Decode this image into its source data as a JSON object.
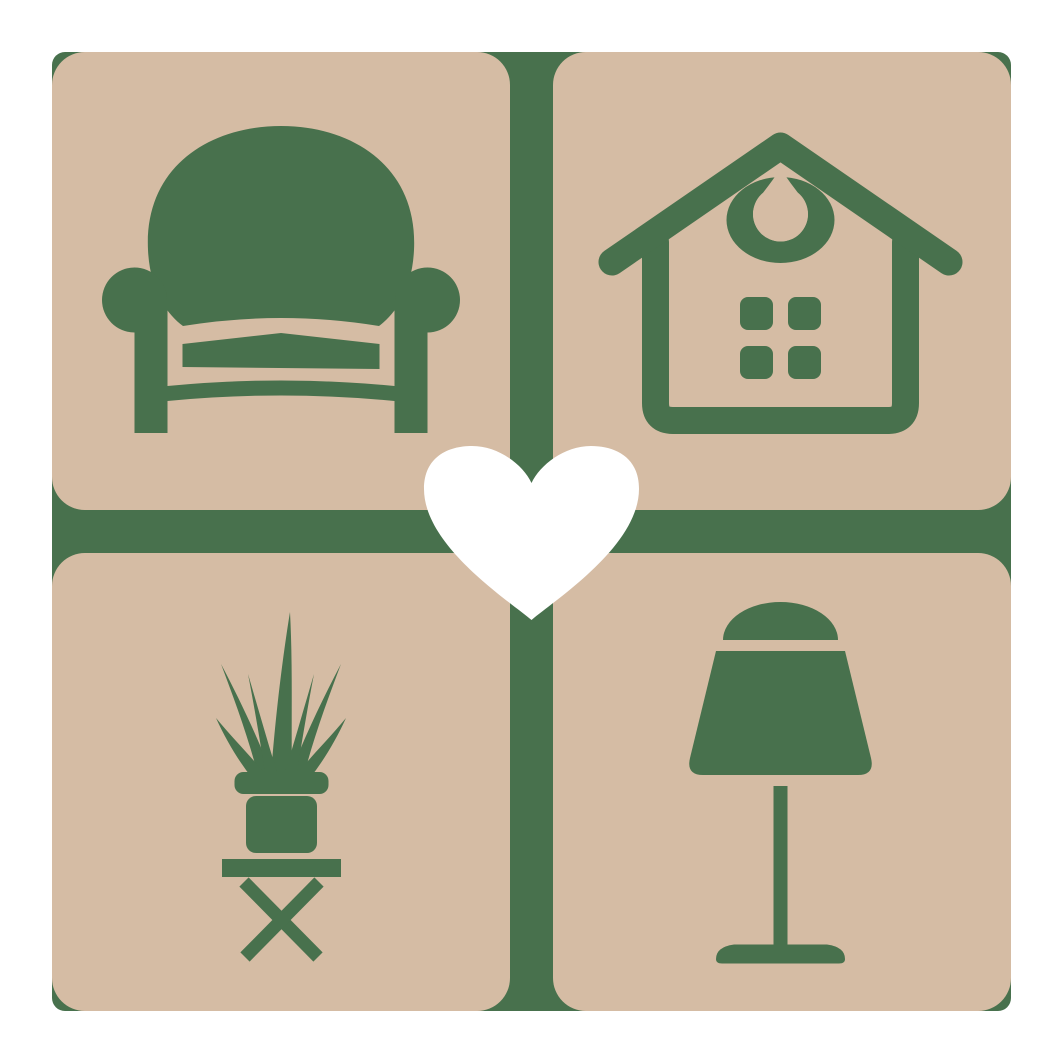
{
  "logo": {
    "colors": {
      "background": "#ffffff",
      "tile": "#d5bca4",
      "icon": "#48714d",
      "heart": "#ffffff"
    },
    "quadrants": [
      {
        "position": "top-left",
        "icon": "armchair-icon"
      },
      {
        "position": "top-right",
        "icon": "house-icon"
      },
      {
        "position": "bottom-left",
        "icon": "potted-plant-icon"
      },
      {
        "position": "bottom-right",
        "icon": "table-lamp-icon"
      }
    ],
    "center_icon": "heart-icon"
  }
}
